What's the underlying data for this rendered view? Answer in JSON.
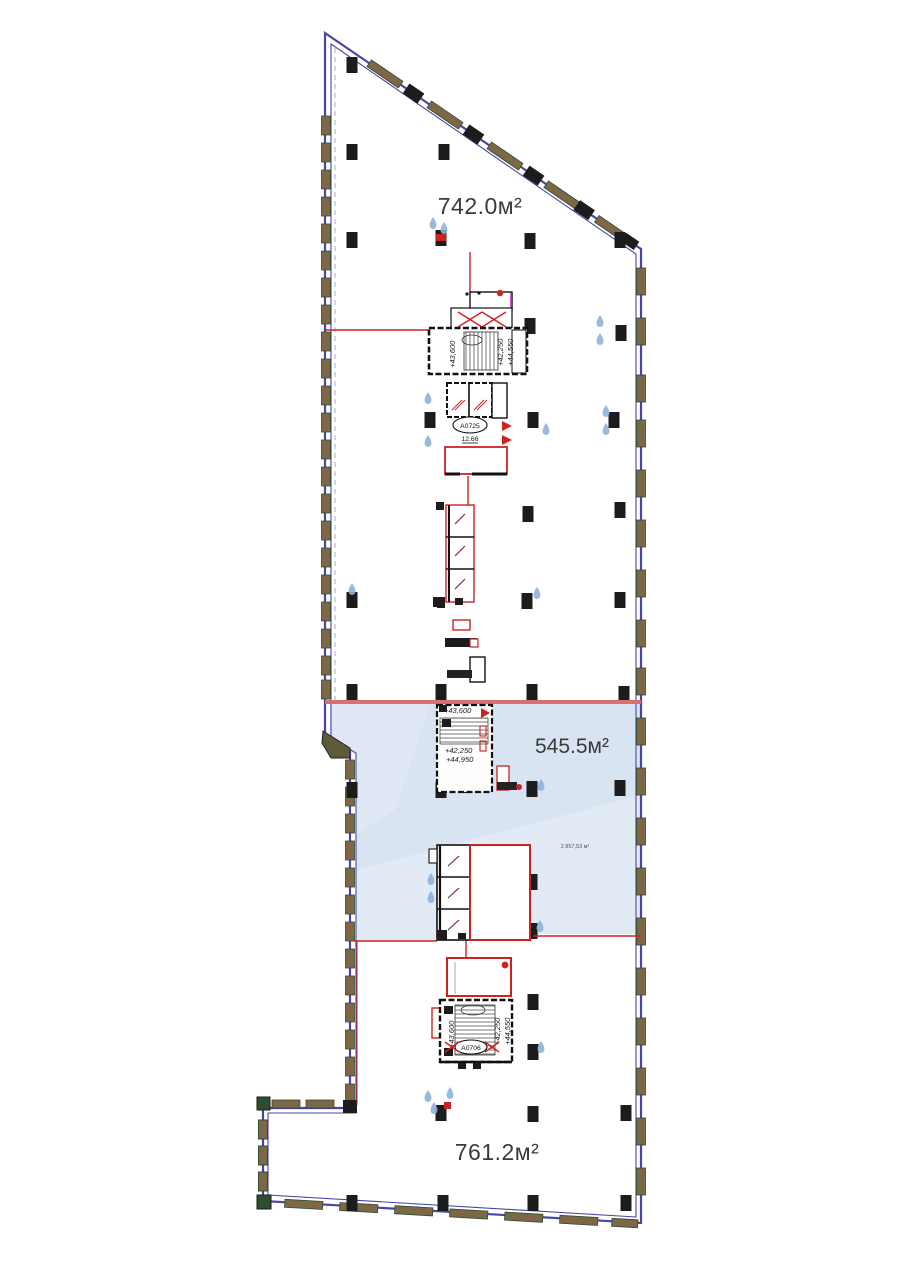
{
  "plan": {
    "zones": [
      {
        "id": "top",
        "area_label": "742.0м²"
      },
      {
        "id": "middle",
        "area_label": "545.5м²",
        "small_note": "2 857,53 м²"
      },
      {
        "id": "bottom",
        "area_label": "761.2м²"
      }
    ],
    "elevations": {
      "core_top": {
        "a": "+43,600",
        "b": "+42,250",
        "c": "+44,550"
      },
      "core_mid": {
        "a": "+43,600",
        "b": "+42,250",
        "c": "+44,950"
      },
      "core_bottom": {
        "a": "+43,600",
        "b": "+42,250",
        "c": "+44,550"
      }
    },
    "tags": {
      "top_core_room": {
        "code": "А0725",
        "area": "12.66"
      },
      "bottom_core_room": {
        "code": "А0706"
      }
    },
    "icons": {
      "sprinkler_drop": "water-drop",
      "fire_point": "fire-equipment-cross"
    },
    "colors": {
      "wall": "#4646a8",
      "window": "#7d6747",
      "window_edge": "#2e4e2e",
      "column": "#1c1c1c",
      "zone_fill": "#d9e4f2",
      "accent_red": "#cc2222",
      "line_pink": "#d97070",
      "drop_blue": "#8fb3d9",
      "magenta": "#cc33cc"
    }
  }
}
